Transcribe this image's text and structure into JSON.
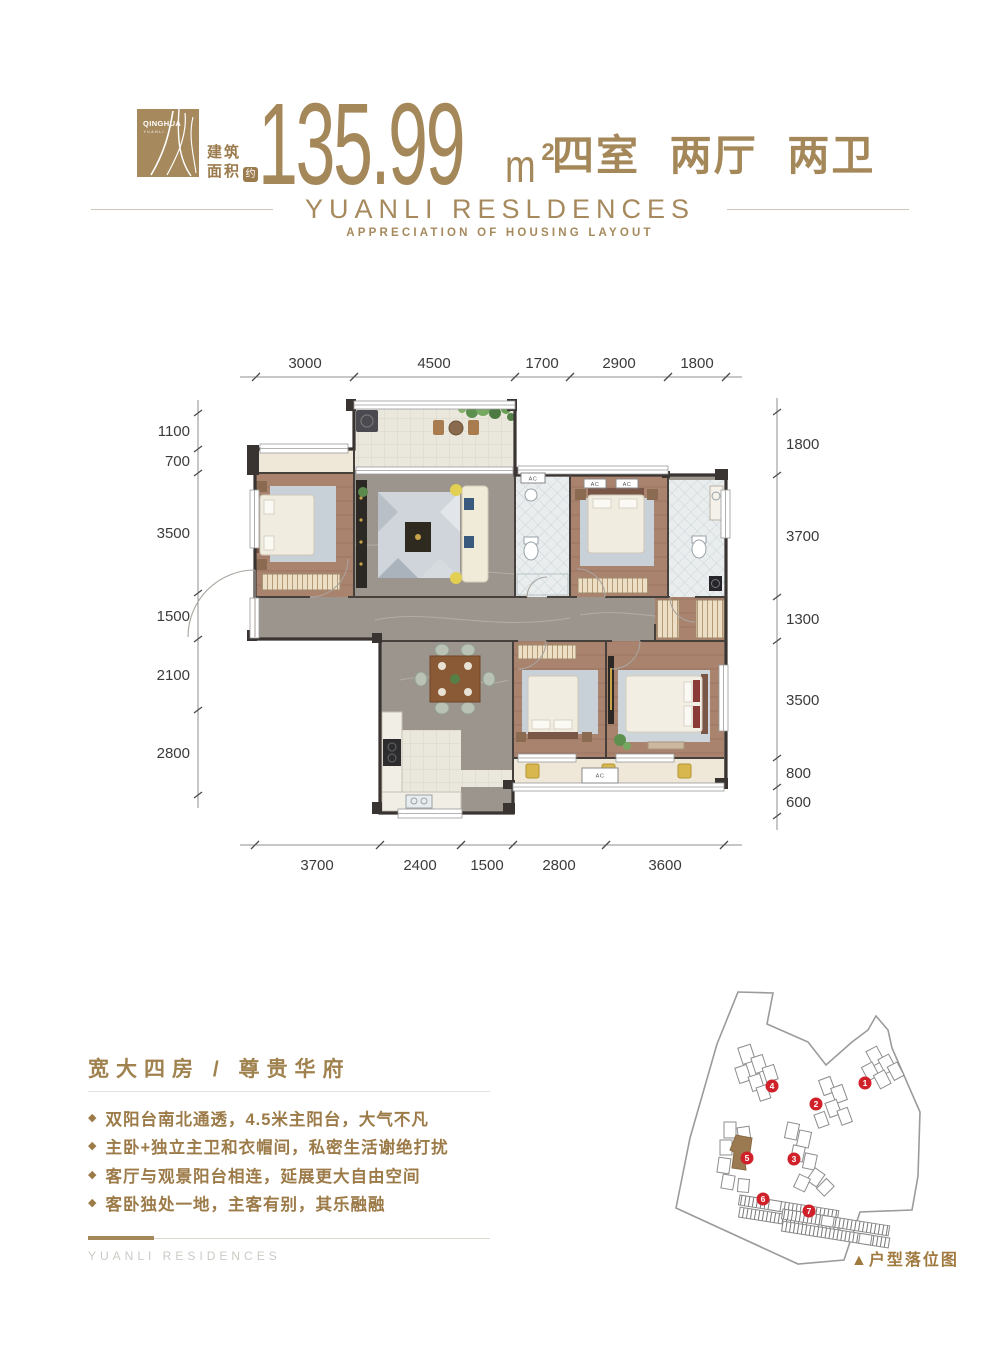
{
  "colors": {
    "brand_gold": "#a5885a",
    "text_brown": "#9c7b49",
    "badge_red": "#d0212b",
    "wall_dark": "#393431",
    "wood_floor": "#a9836e",
    "marble_floor": "#9c958d"
  },
  "header": {
    "logo_line1": "QINGHUA",
    "logo_line2": "YUANLI",
    "area_label_1": "建筑",
    "area_label_2": "面积",
    "area_approx": "约",
    "area_value": "135.99",
    "unit_base": "m",
    "unit_sup": "2",
    "rooms": "四室 两厅 两卫",
    "title": "YUANLI RESLDENCES",
    "subtitle": "APPRECIATION OF HOUSING LAYOUT"
  },
  "floorplan": {
    "ac_label": "AC",
    "dims_top": [
      "3000",
      "4500",
      "1700",
      "2900",
      "1800"
    ],
    "dims_bottom": [
      "3700",
      "2400",
      "1500",
      "2800",
      "3600"
    ],
    "dims_left": [
      "1100",
      "700",
      "3500",
      "1500",
      "2100",
      "2800"
    ],
    "dims_right": [
      "1800",
      "3700",
      "1300",
      "3500",
      "800",
      "600"
    ]
  },
  "features": {
    "heading": "宽大四房 / 尊贵华府",
    "bullet": "◆",
    "items": [
      "双阳台南北通透，4.5米主阳台，大气不凡",
      "主卧+独立主卫和衣帽间，私密生活谢绝打扰",
      "客厅与观景阳台相连，延展更大自由空间",
      "客卧独处一地，主客有别，其乐融融"
    ]
  },
  "footer": {
    "brand": "YUANLI RESIDENCES"
  },
  "site_plan": {
    "caption": "▲户型落位图",
    "badges": [
      "1",
      "2",
      "3",
      "4",
      "5",
      "6",
      "7"
    ]
  }
}
